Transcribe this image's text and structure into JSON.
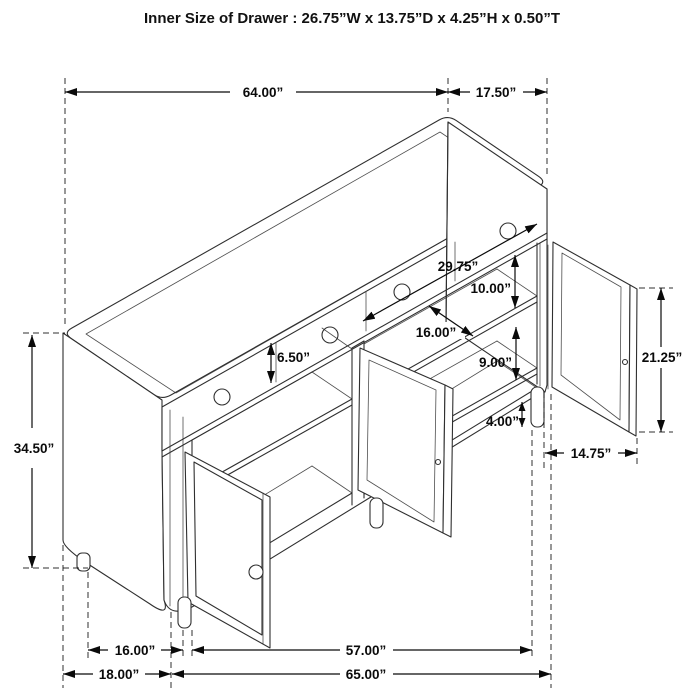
{
  "title": "Inner Size of Drawer : 26.75”W x 13.75”D x 4.25”H x 0.50”T",
  "dims": {
    "top_width": "64.00”",
    "top_depth": "17.50”",
    "overall_height": "34.50”",
    "drawer_face_height": "6.50”",
    "cabinet_inner_width": "29.75”",
    "upper_shelf_gap": "10.00”",
    "shelf_depth": "16.00”",
    "lower_shelf_gap": "9.00”",
    "leg_height": "4.00”",
    "door_height": "21.25”",
    "door_width": "14.75”",
    "feet_depth": "16.00”",
    "feet_span": "57.00”",
    "base_depth": "18.00”",
    "base_width": "65.00”"
  },
  "colors": {
    "background": "#ffffff",
    "furniture_line": "#2f2f2f",
    "dimension_line": "#0a0a0a",
    "mesh_line": "#999999"
  }
}
